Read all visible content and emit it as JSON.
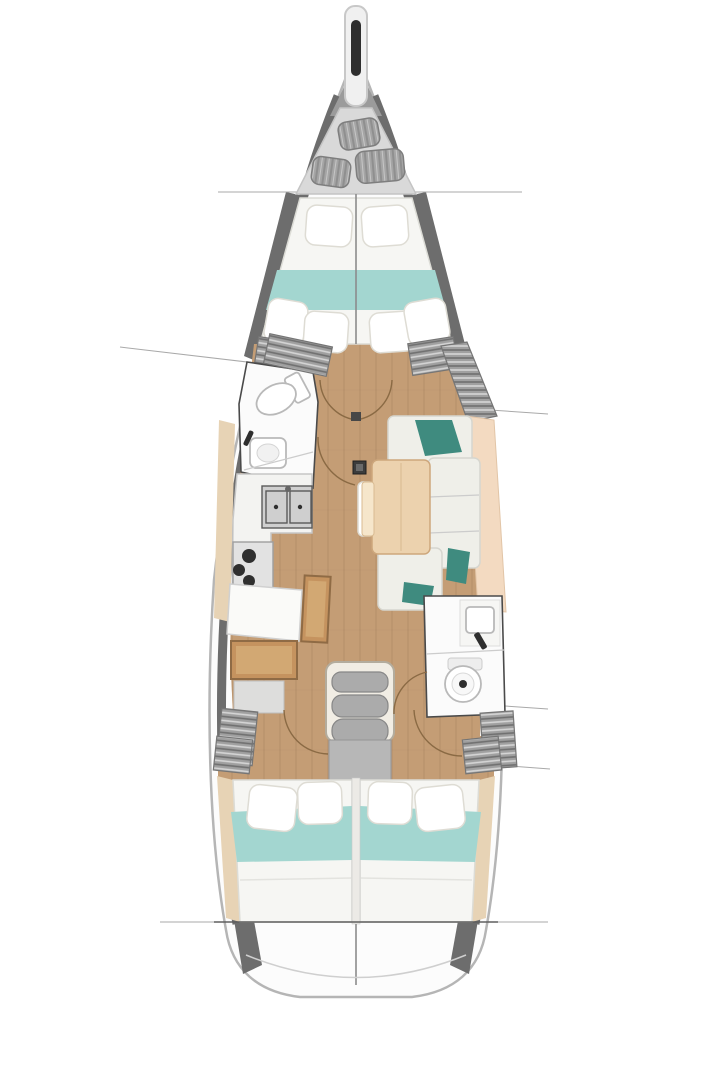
{
  "diagram": {
    "type": "yacht-interior-floor-plan",
    "orientation": "bow-up",
    "zones": [
      "bowsprit-anchor-roller",
      "sail-locker",
      "forward-cabin-vberth",
      "forward-head",
      "galley",
      "nav-station",
      "salon-settee",
      "salon-table",
      "companionway-stairs",
      "aft-head",
      "aft-cabin-port",
      "aft-cabin-starboard",
      "stern"
    ],
    "station_reference_lines": 6,
    "door_swing_arcs": 6
  },
  "colors": {
    "hull_fill": "#fcfcfc",
    "hull_outline": "#b5b5b5",
    "hull_wall": "#6d6d6d",
    "deck_gray": "#9b9b9b",
    "sail_locker_bg": "#d9d9d9",
    "fender_gray": "#a5a5a5",
    "wood_floor": "#c49d75",
    "wood_plank_line": "#ab8560",
    "wood_light": "#ecd2ae",
    "wood_mid": "#c5935f",
    "wood_dark": "#8f6b45",
    "wood_shelf": "#e7d3b5",
    "bed_white": "#f6f6f3",
    "cushion_white": "#efefe9",
    "pillow_stroke": "#dedcd4",
    "teal_light": "#a3d6d0",
    "teal_dark": "#3f8b7f",
    "peach": "#f3dac1",
    "room_white": "#fbfbfb",
    "room_outline": "#4a4a4a",
    "fixture_white": "#ffffff",
    "fixture_stroke": "#b9b9b9",
    "steel_dark": "#5a5a5a",
    "burner_dark": "#2f2f2f",
    "stair_frame": "#f1ede4",
    "stair_tread": "#ababab",
    "landing_gray": "#b7b7b7",
    "door_arc": "#8a6a44",
    "ref_line": "#a9a9a9",
    "center_line": "#8c8c8c",
    "anchor_dark": "#2e2e2e"
  }
}
